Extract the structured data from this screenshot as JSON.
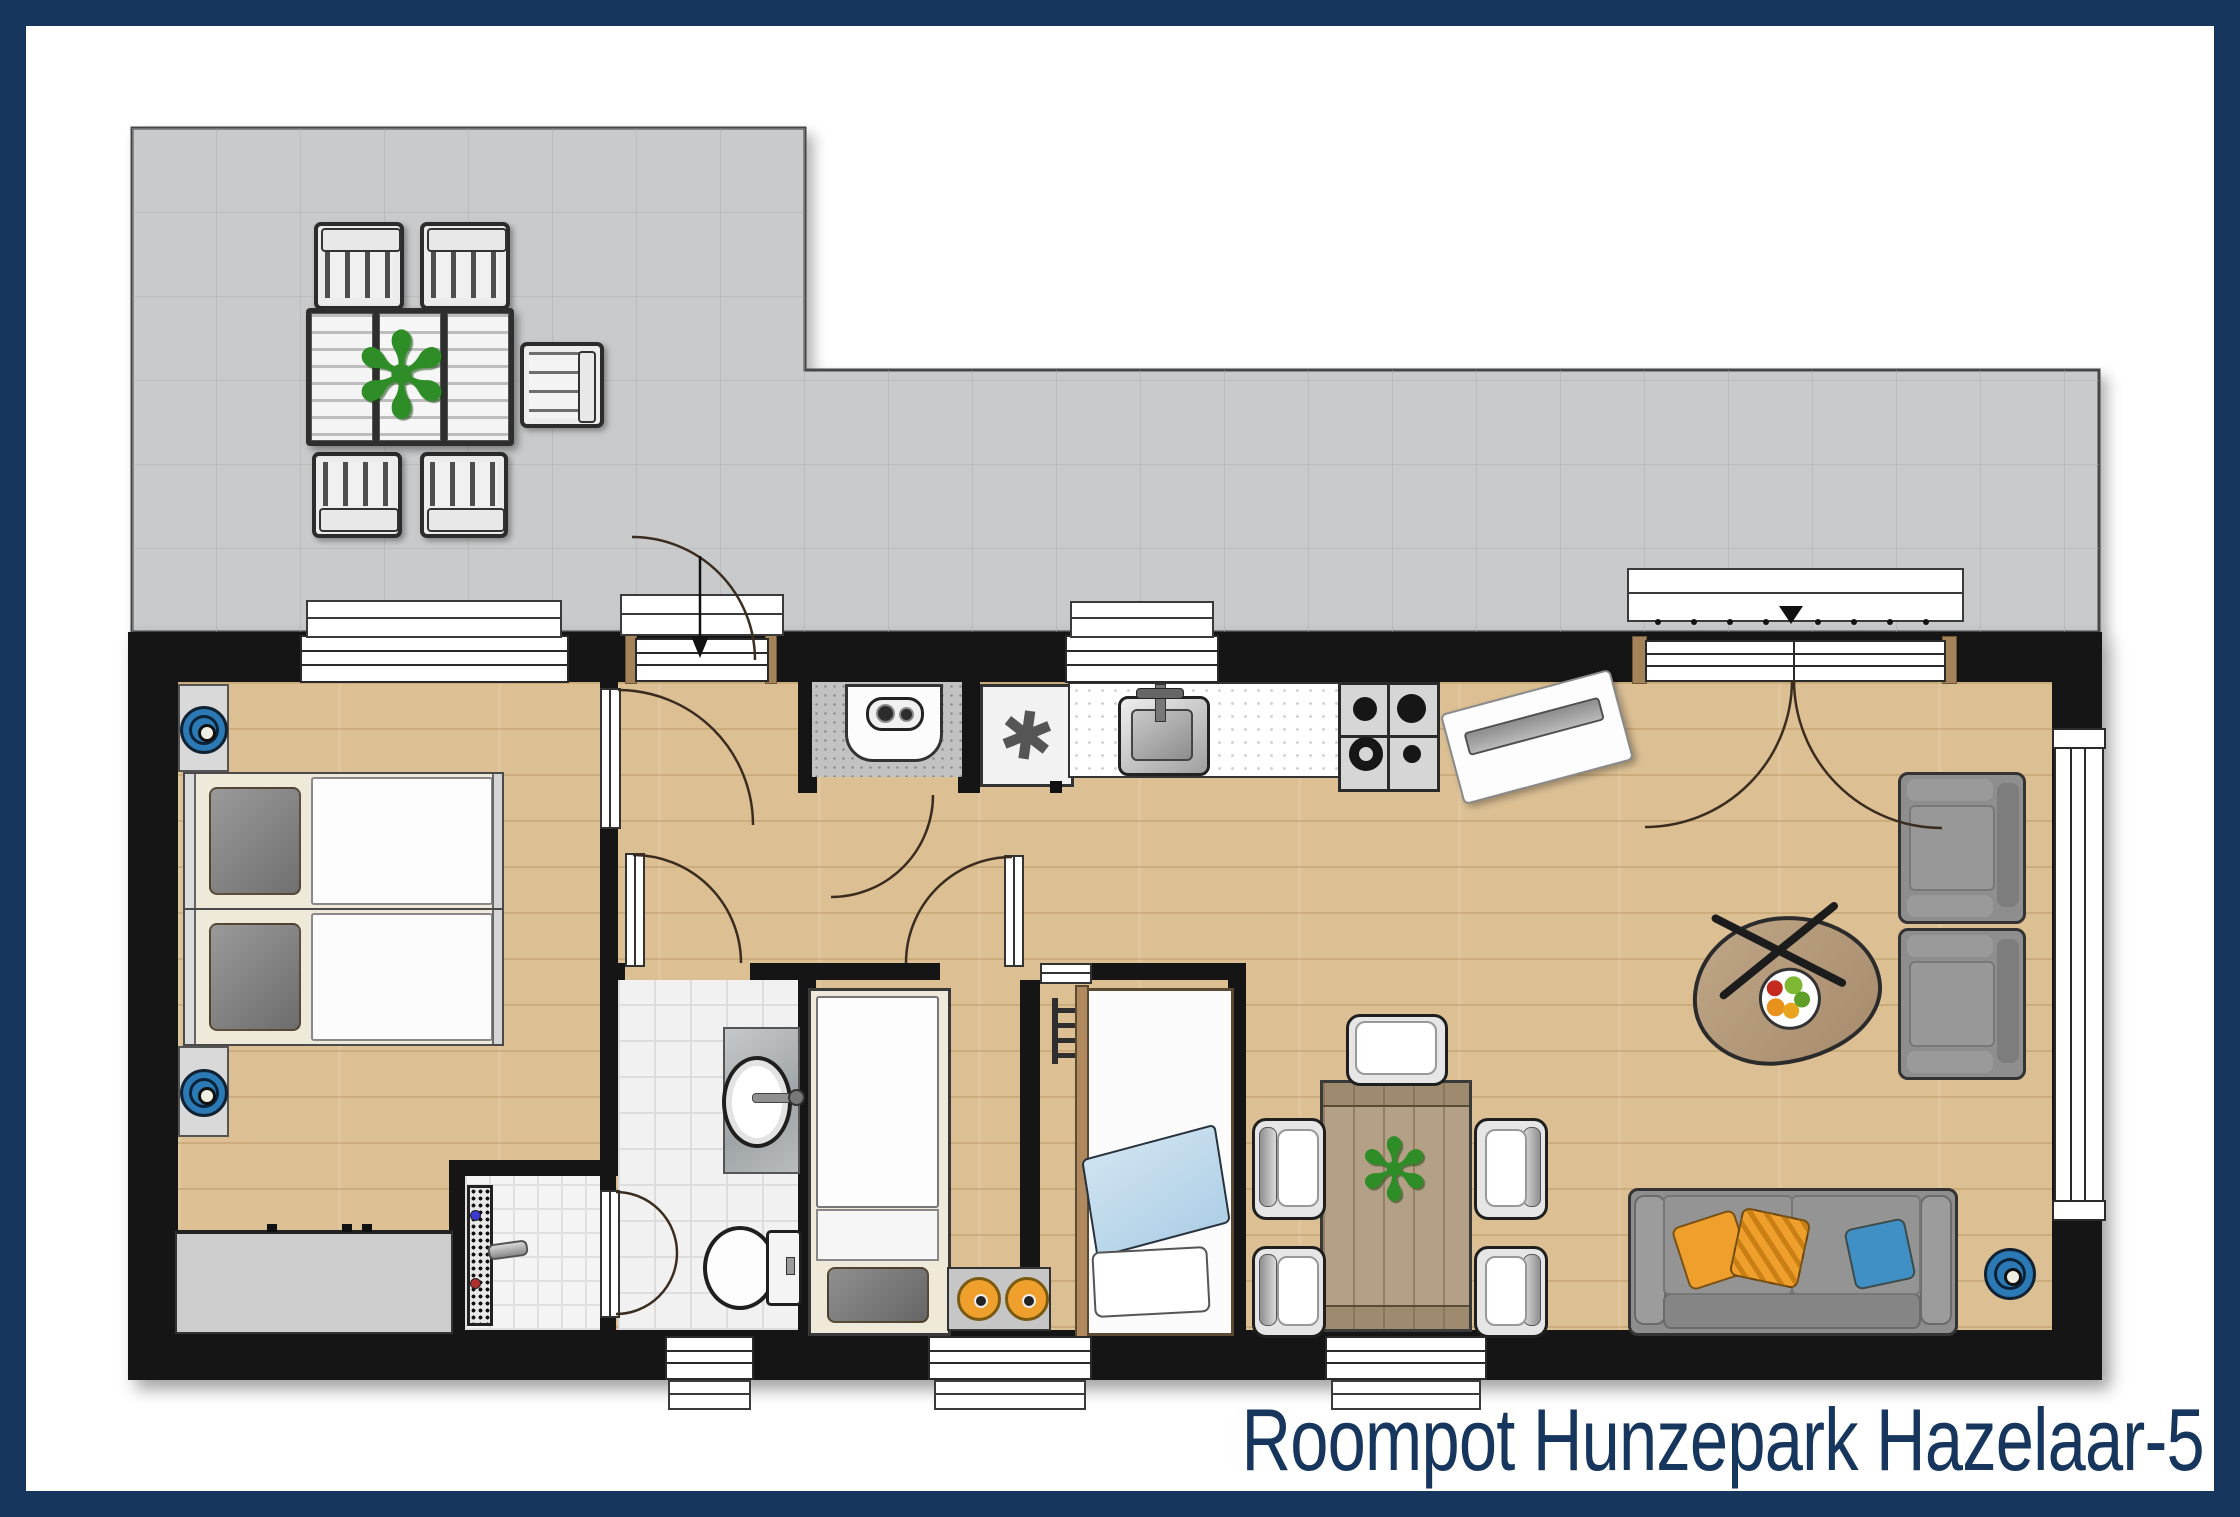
{
  "title": "Roompot Hunzepark Hazelaar-5",
  "palette": {
    "frame": "#17365d",
    "wall": "#151515",
    "terrace": "#c9cacb",
    "wood": "#dcc094",
    "tile": "#f1f1f1",
    "sofa_gray": "#8e8e8e",
    "pillow_orange": "#efa02c",
    "pillow_blue": "#4090c6",
    "icon_blue": "#2c7ab5",
    "plant_green": "#2f8d27",
    "door_jamb_brown": "#a5835a"
  },
  "plan": {
    "type": "holiday-cottage-floor-plan",
    "areas": [
      {
        "name": "terrace",
        "floor": "gray-tiles",
        "items": [
          "outdoor-dining-table",
          "potted-plant",
          "outdoor-chair",
          "outdoor-chair",
          "outdoor-chair",
          "outdoor-chair",
          "garden-bench"
        ]
      },
      {
        "name": "bedroom-1",
        "floor": "wood",
        "items": [
          "twin-bed",
          "twin-bed",
          "dresser",
          "wall-spot",
          "wall-spot",
          "window"
        ]
      },
      {
        "name": "shower-room",
        "floor": "small-tiles",
        "items": [
          "shower-drain",
          "mixer-tap",
          "shower-door"
        ]
      },
      {
        "name": "bathroom",
        "floor": "tiles",
        "items": [
          "washbasin",
          "vanity-counter",
          "toilet",
          "window"
        ]
      },
      {
        "name": "bedroom-2",
        "floor": "wood",
        "items": [
          "bunk-bed",
          "step-stool",
          "window"
        ]
      },
      {
        "name": "bedroom-3",
        "floor": "wood",
        "items": [
          "single-bed",
          "ladder",
          "blue-blanket",
          "pillow"
        ]
      },
      {
        "name": "kitchen",
        "floor": "wood",
        "items": [
          "washing-machine-closet",
          "freezer",
          "sink-counter",
          "gas-hob",
          "doormat",
          "window"
        ]
      },
      {
        "name": "living-room",
        "floor": "wood",
        "items": [
          "dining-table",
          "dining-chair",
          "dining-chair",
          "dining-chair",
          "dining-chair",
          "dining-chair",
          "potted-plant",
          "sofa",
          "cushion-orange",
          "cushion-orange-striped",
          "cushion-blue",
          "armchair",
          "armchair",
          "coffee-table",
          "fruit-bowl",
          "floor-lamp",
          "window",
          "french-doors"
        ]
      },
      {
        "name": "hallway",
        "floor": "wood",
        "items": [
          "entrance-door",
          "interior-doors"
        ]
      }
    ]
  }
}
